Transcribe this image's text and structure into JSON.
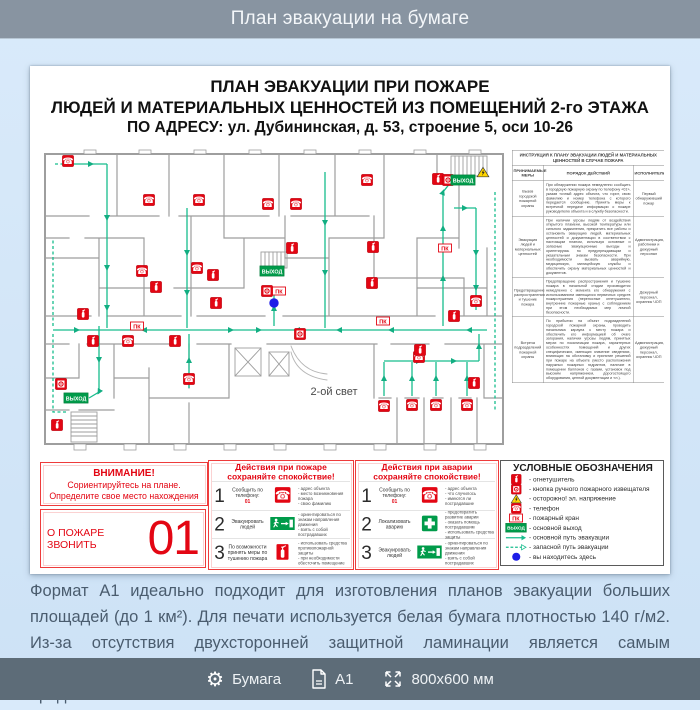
{
  "header": {
    "title": "План эвакуации на бумаге"
  },
  "poster": {
    "title": {
      "line1": "ПЛАН ЭВАКУАЦИИ ПРИ ПОЖАРЕ",
      "line2": "ЛЮДЕЙ И МАТЕРИАЛЬНЫХ ЦЕННОСТЕЙ ИЗ ПОМЕЩЕНИЙ 2-го ЭТАЖА",
      "line3": "ПО АДРЕСУ: ул. Дубининская, д. 53, строение 5, оси 10-26"
    },
    "plan": {
      "second_light_label": "2-ой свет",
      "exit_label": "ВЫХОД",
      "pk_label": "ПК",
      "markers": [
        {
          "t": "phone",
          "x": 29,
          "y": 13
        },
        {
          "t": "phone",
          "x": 110,
          "y": 52
        },
        {
          "t": "phone",
          "x": 160,
          "y": 52
        },
        {
          "t": "phone",
          "x": 229,
          "y": 56
        },
        {
          "t": "phone",
          "x": 257,
          "y": 56
        },
        {
          "t": "phone",
          "x": 328,
          "y": 32
        },
        {
          "t": "phone",
          "x": 103,
          "y": 123
        },
        {
          "t": "phone",
          "x": 158,
          "y": 120
        },
        {
          "t": "phone",
          "x": 437,
          "y": 153
        },
        {
          "t": "phone",
          "x": 89,
          "y": 193
        },
        {
          "t": "phone",
          "x": 150,
          "y": 231
        },
        {
          "t": "phone",
          "x": 380,
          "y": 209
        },
        {
          "t": "phone",
          "x": 345,
          "y": 258
        },
        {
          "t": "phone",
          "x": 373,
          "y": 257
        },
        {
          "t": "phone",
          "x": 397,
          "y": 257
        },
        {
          "t": "phone",
          "x": 428,
          "y": 257
        },
        {
          "t": "ext",
          "x": 253,
          "y": 100
        },
        {
          "t": "ext",
          "x": 334,
          "y": 99
        },
        {
          "t": "ext",
          "x": 174,
          "y": 127
        },
        {
          "t": "ext",
          "x": 117,
          "y": 139
        },
        {
          "t": "ext",
          "x": 177,
          "y": 155
        },
        {
          "t": "ext",
          "x": 44,
          "y": 166
        },
        {
          "t": "ext",
          "x": 333,
          "y": 135
        },
        {
          "t": "ext",
          "x": 415,
          "y": 168
        },
        {
          "t": "ext",
          "x": 54,
          "y": 193
        },
        {
          "t": "ext",
          "x": 136,
          "y": 193
        },
        {
          "t": "ext",
          "x": 381,
          "y": 202
        },
        {
          "t": "ext",
          "x": 435,
          "y": 235
        },
        {
          "t": "ext",
          "x": 18,
          "y": 277
        },
        {
          "t": "ext",
          "x": 399,
          "y": 31
        },
        {
          "t": "btn",
          "x": 228,
          "y": 143
        },
        {
          "t": "btn",
          "x": 409,
          "y": 32
        },
        {
          "t": "btn",
          "x": 22,
          "y": 236
        },
        {
          "t": "btn",
          "x": 261,
          "y": 186
        },
        {
          "t": "pk",
          "x": 240,
          "y": 143
        },
        {
          "t": "pk",
          "x": 98,
          "y": 178
        },
        {
          "t": "pk",
          "x": 344,
          "y": 173
        },
        {
          "t": "pk",
          "x": 406,
          "y": 100
        },
        {
          "t": "exit",
          "x": 424,
          "y": 32
        },
        {
          "t": "exit",
          "x": 233,
          "y": 123
        },
        {
          "t": "exit",
          "x": 37,
          "y": 250
        },
        {
          "t": "warn",
          "x": 444,
          "y": 24
        },
        {
          "t": "you",
          "x": 235,
          "y": 155
        }
      ]
    },
    "instruction": {
      "title": "ИНСТРУКЦИЯ К ПЛАНУ ЭВАКУАЦИИ ЛЮДЕЙ И МАТЕРИАЛЬНЫХ ЦЕННОСТЕЙ В СЛУЧАЕ ПОЖАРА",
      "columns": [
        "ПРИНИМАЕМЫЕ МЕРЫ",
        "ПОРЯДОК ДЕЙСТВИЙ",
        "ИСПОЛНИТЕЛИ"
      ],
      "rows": [
        {
          "measure": "Вызов городской пожарной охраны",
          "action": "При обнаружении пожара немедленно сообщить в городскую пожарную охрану по телефону «01», указав точный адрес объекта, что горит, свою фамилию и номер телефона с которого передается сообщение. Принять меры к встречной передаче информации о пожаре руководителю объекта и в службу безопасности.",
          "executors": "Первый обнаруживший пожар"
        },
        {
          "measure": "Эвакуация людей и материальных ценностей",
          "action": "При наличии угрозы людям от воздействия открытого пламени, высокой температуры или сильного задымления, прекратить все работы и остановить эвакуацию людей, материальных ценностей и документации в соответствии с настоящим планом, используя основные и запасные эвакуационные выходы и ориентируясь по предупреждающим и указательным знакам безопасности. При необходимости вызвать аварийную, медицинскую, милицейскую службы и обеспечить охрану материальных ценностей и документов.",
          "executors": "Администрация, работники и дежурный персонал"
        },
        {
          "measure": "Предотвращение распространения и тушение пожара",
          "action": "Предотвращение распространения и тушение пожара в начальной стадии производится немедленно с момента его обнаружения с использованием имеющихся первичных средств пожаротушения (переносные огнетушители, внутренние пожарные краны) с соблюдением при этом необходимых мер личной безопасности.",
          "executors": "Дежурный персонал, охранник ЧОП"
        },
        {
          "measure": "Встреча подразделений пожарной охраны",
          "action": "По прибытии на объект подразделений городской пожарной охраны, проводить начальника караула к месту пожара и обеспечить его информацией об очаге загорания, наличии угрозы людям, принятых мерах по локализации пожара, характерных особенностях помещений и других специфических, имеющих значение сведениях, влияющих на обстановку и принятие решений при пожаре на объекте (место расположения наружных пожарных гидрантов, наличие в помещении баллонов с газами, установок под высоким напряжением, дорогостоящего оборудования, ценной документации и т.п.).",
          "executors": "Администрация, дежурный персонал, охранник ЧОП"
        }
      ]
    },
    "attention": {
      "line1": "ВНИМАНИЕ!",
      "line2": "Сориентируйтесь на плане.",
      "line3": "Определите свое место нахождения"
    },
    "call": {
      "label": "О ПОЖАРЕ ЗВОНИТЬ",
      "number": "01"
    },
    "fire_actions": {
      "title1": "Действия при пожаре",
      "title2": "сохраняйте спокойствие!",
      "rows": [
        {
          "num": "1",
          "label": "Сообщить по телефону:",
          "accent": "01",
          "icon": "phone",
          "bullets": [
            "адрес объекта",
            "место возникновения пожара",
            "свою фамилию"
          ]
        },
        {
          "num": "2",
          "label": "Эвакуировать людей",
          "accent": "",
          "icon": "exit",
          "bullets": [
            "ориентироваться по знакам направления движения",
            "взять с собой пострадавших"
          ]
        },
        {
          "num": "3",
          "label": "По возможности принять меры по тушению пожара",
          "accent": "",
          "icon": "ext",
          "bullets": [
            "использовать средства противопожарной защиты",
            "при необходимости обесточить помещение"
          ]
        }
      ]
    },
    "accident_actions": {
      "title1": "Действия при аварии",
      "title2": "сохраняйте спокойствие!",
      "rows": [
        {
          "num": "1",
          "label": "Сообщить по телефону:",
          "accent": "01",
          "icon": "phone",
          "bullets": [
            "адрес объекта",
            "что случилось",
            "имеются ли пострадавшие"
          ]
        },
        {
          "num": "2",
          "label": "Локализовать аварию",
          "accent": "",
          "icon": "cross",
          "bullets": [
            "предотвратить развитие аварии",
            "оказать помощь пострадавшим",
            "использовать средства защиты"
          ]
        },
        {
          "num": "3",
          "label": "Эвакуировать людей",
          "accent": "",
          "icon": "exit",
          "bullets": [
            "ориентироваться по знакам направления движения",
            "взять с собой пострадавших"
          ]
        }
      ]
    },
    "legend": {
      "title": "УСЛОВНЫЕ ОБОЗНАЧЕНИЯ",
      "items": [
        {
          "icon": "extinguisher-icon",
          "label": "огнетушитель"
        },
        {
          "icon": "call-point-icon",
          "label": "кнопка ручного пожарного извещателя"
        },
        {
          "icon": "voltage-icon",
          "label": "осторожно! эл. напряжение"
        },
        {
          "icon": "phone-icon",
          "label": "телефон"
        },
        {
          "icon": "hydrant-icon",
          "label": "пожарный кран"
        },
        {
          "icon": "exit-icon",
          "label": "основной выход"
        },
        {
          "icon": "main-route-icon",
          "label": "основной путь эвакуации"
        },
        {
          "icon": "reserve-route-icon",
          "label": "запасной путь эвакуации"
        },
        {
          "icon": "you-are-here-icon",
          "label": "вы находитесь здесь"
        }
      ]
    }
  },
  "description": {
    "text": "Формат А1 идеально подходит для изготовления планов эвакуации больших площадей (до 1 км²). Для печати используется белая бумага плотностью 140 г/м2. Из-за отсутствия двухсторонней защитной ламинации является самым бюджетным, но одновременно и самым недолговечным вариантом из представленных"
  },
  "footer": {
    "items": [
      {
        "icon": "gear-icon",
        "label": "Бумага"
      },
      {
        "icon": "sheet-icon",
        "label": "А1"
      },
      {
        "icon": "dimensions-icon",
        "label": "800х600 мм"
      }
    ]
  },
  "colors": {
    "red": "#e30613",
    "sign_green": "#009b4a",
    "route": "#17bd8d",
    "blue": "#1d1de8",
    "header_bg": "#8894a1",
    "footer_bg": "#5d6c78"
  }
}
